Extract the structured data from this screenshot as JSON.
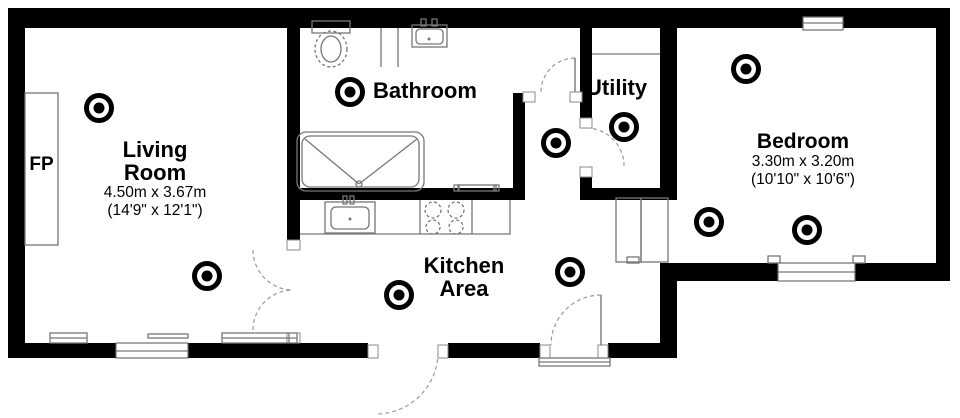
{
  "colors": {
    "wall": "#000000",
    "fixture": "#777777",
    "dash": "#9a9a9a",
    "text": "#000000",
    "bg": "#ffffff"
  },
  "rooms": {
    "living": {
      "line1": "Living",
      "line2": "Room",
      "metric": "4.50m x 3.67m",
      "imperial": "(14'9\" x 12'1\")"
    },
    "bathroom": {
      "name": "Bathroom"
    },
    "utility": {
      "name": "Utility"
    },
    "bedroom": {
      "name": "Bedroom",
      "metric": "3.30m x 3.20m",
      "imperial": "(10'10\" x 10'6\")"
    },
    "kitchen": {
      "line1": "Kitchen",
      "line2": "Area"
    },
    "fireplace": {
      "label": "FP"
    }
  },
  "detectors": [
    {
      "x": 99,
      "y": 108
    },
    {
      "x": 350,
      "y": 92
    },
    {
      "x": 556,
      "y": 143
    },
    {
      "x": 624,
      "y": 127
    },
    {
      "x": 746,
      "y": 69
    },
    {
      "x": 207,
      "y": 276
    },
    {
      "x": 399,
      "y": 295
    },
    {
      "x": 570,
      "y": 272
    },
    {
      "x": 709,
      "y": 222
    },
    {
      "x": 807,
      "y": 230
    }
  ]
}
